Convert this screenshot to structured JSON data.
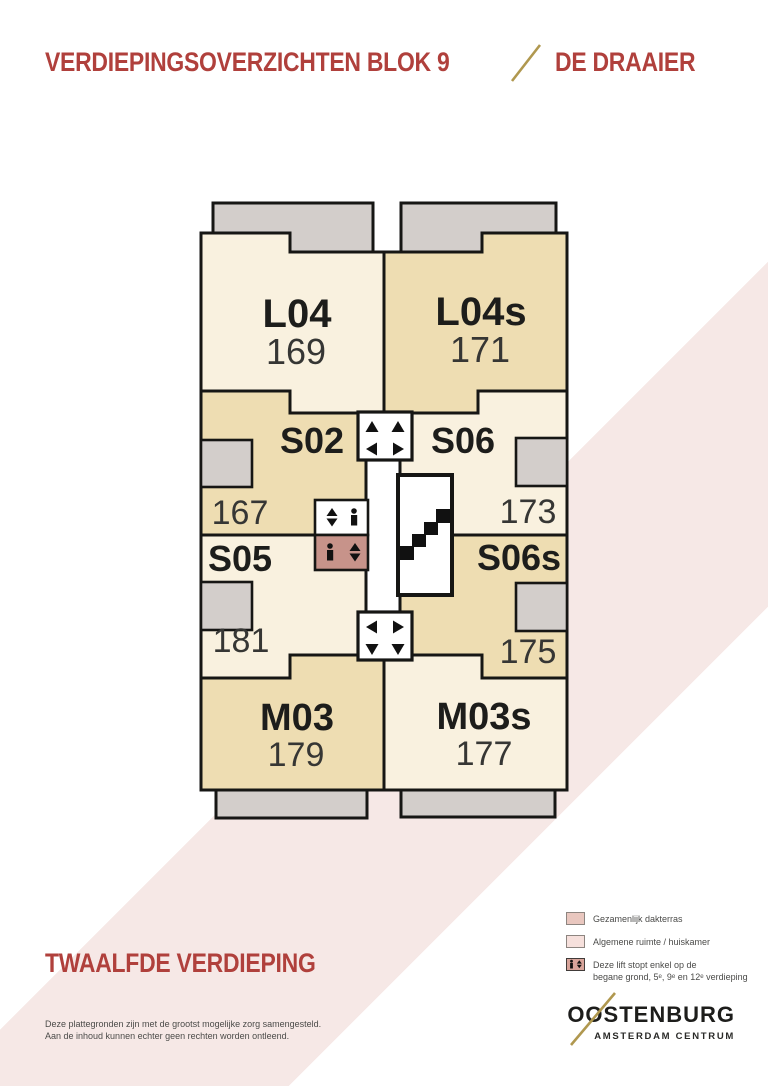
{
  "header": {
    "title": "VERDIEPINGSOVERZICHTEN BLOK 9",
    "subtitle": "DE DRAAIER"
  },
  "floor_label": "TWAALFDE VERDIEPING",
  "plan": {
    "units": [
      {
        "code": "L04",
        "number": "169",
        "shade": "cream"
      },
      {
        "code": "L04s",
        "number": "171",
        "shade": "tan"
      },
      {
        "code": "S02",
        "number": "167",
        "shade": "tan"
      },
      {
        "code": "S06",
        "number": "173",
        "shade": "cream"
      },
      {
        "code": "S05",
        "number": "181",
        "shade": "cream"
      },
      {
        "code": "S06s",
        "number": "175",
        "shade": "tan"
      },
      {
        "code": "M03",
        "number": "179",
        "shade": "tan"
      },
      {
        "code": "M03s",
        "number": "177",
        "shade": "cream"
      }
    ],
    "icons": {
      "stairs": "staircase",
      "lift": "person + up/down arrows",
      "landing_top": "up/left/right arrows",
      "landing_bottom": "left/right/down arrows"
    }
  },
  "legend": {
    "items": [
      {
        "label": "Gezamenlijk dakterras"
      },
      {
        "label": "Algemene ruimte / huiskamer"
      },
      {
        "label_line1": "Deze lift stopt enkel op de",
        "label_line2": "begane grond, 5ᵉ, 9ᵉ en 12ᵉ verdieping"
      }
    ]
  },
  "logo": {
    "name": "OOSTENBURG",
    "subtitle": "AMSTERDAM CENTRUM"
  },
  "disclaimer": {
    "line1": "Deze plattegronden zijn met de grootst mogelijke zorg samengesteld.",
    "line2": "Aan de inhoud kunnen echter geen rechten worden ontleend."
  },
  "colors": {
    "header_red": "#b0403c",
    "gold": "#b0984f",
    "unit_cream": "#f9f1df",
    "unit_tan": "#eeddb2",
    "balcony_gray": "#d3cecb",
    "band_pink": "#f6e8e6",
    "restricted_lift_rose": "#c7938a",
    "legend_dakterras": "#e9c7bf",
    "legend_algemene": "#f6e0dc",
    "legend_lift": "#d8a49a",
    "wall": "#161614"
  }
}
